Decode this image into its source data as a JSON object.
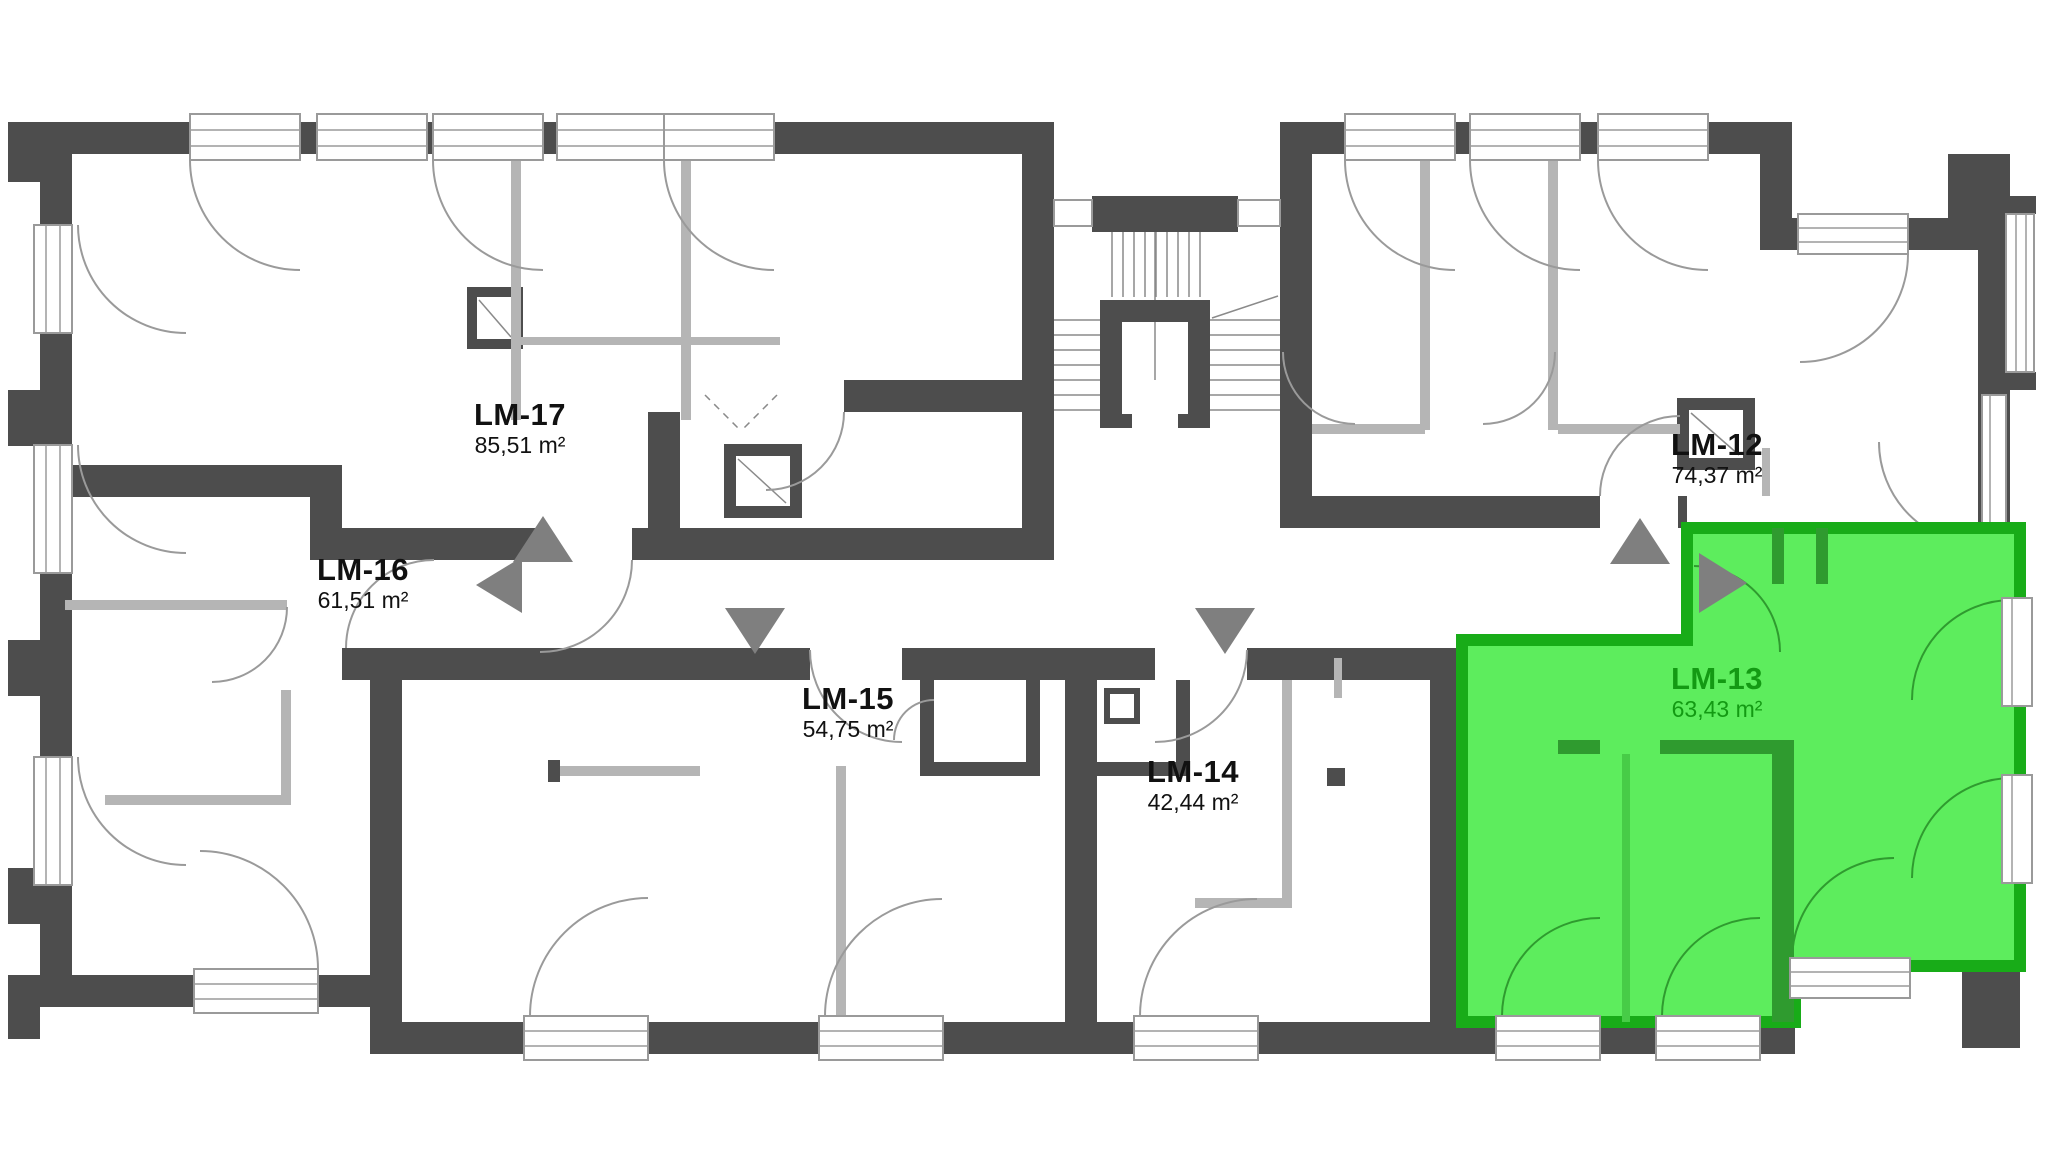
{
  "plan": {
    "highlighted_apartment": "LM-13",
    "apartments": [
      {
        "id": "LM-17",
        "area": "85,51 m²",
        "highlighted": false
      },
      {
        "id": "LM-16",
        "area": "61,51 m²",
        "highlighted": false
      },
      {
        "id": "LM-15",
        "area": "54,75 m²",
        "highlighted": false
      },
      {
        "id": "LM-14",
        "area": "42,44 m²",
        "highlighted": false
      },
      {
        "id": "LM-12",
        "area": "74,37 m²",
        "highlighted": false
      },
      {
        "id": "LM-13",
        "area": "63,43 m²",
        "highlighted": true
      }
    ],
    "entrance_arrows": [
      {
        "apartment": "LM-17",
        "direction": "up"
      },
      {
        "apartment": "LM-16",
        "direction": "left"
      },
      {
        "apartment": "LM-15",
        "direction": "down"
      },
      {
        "apartment": "LM-14",
        "direction": "down"
      },
      {
        "apartment": "LM-12",
        "direction": "up"
      },
      {
        "apartment": "LM-13",
        "direction": "right"
      }
    ],
    "colors": {
      "wall": "#4d4d4d",
      "partition": "#b5b5b5",
      "line": "#9a9a9a",
      "arrow": "#7f7f7f",
      "label_text": "#111111",
      "highlight_fill": "#5ded5d",
      "highlight_border": "#18ac18",
      "highlight_wall": "#2f9b2f",
      "highlight_partition": "#47cc47",
      "highlight_text": "#139a13"
    }
  }
}
